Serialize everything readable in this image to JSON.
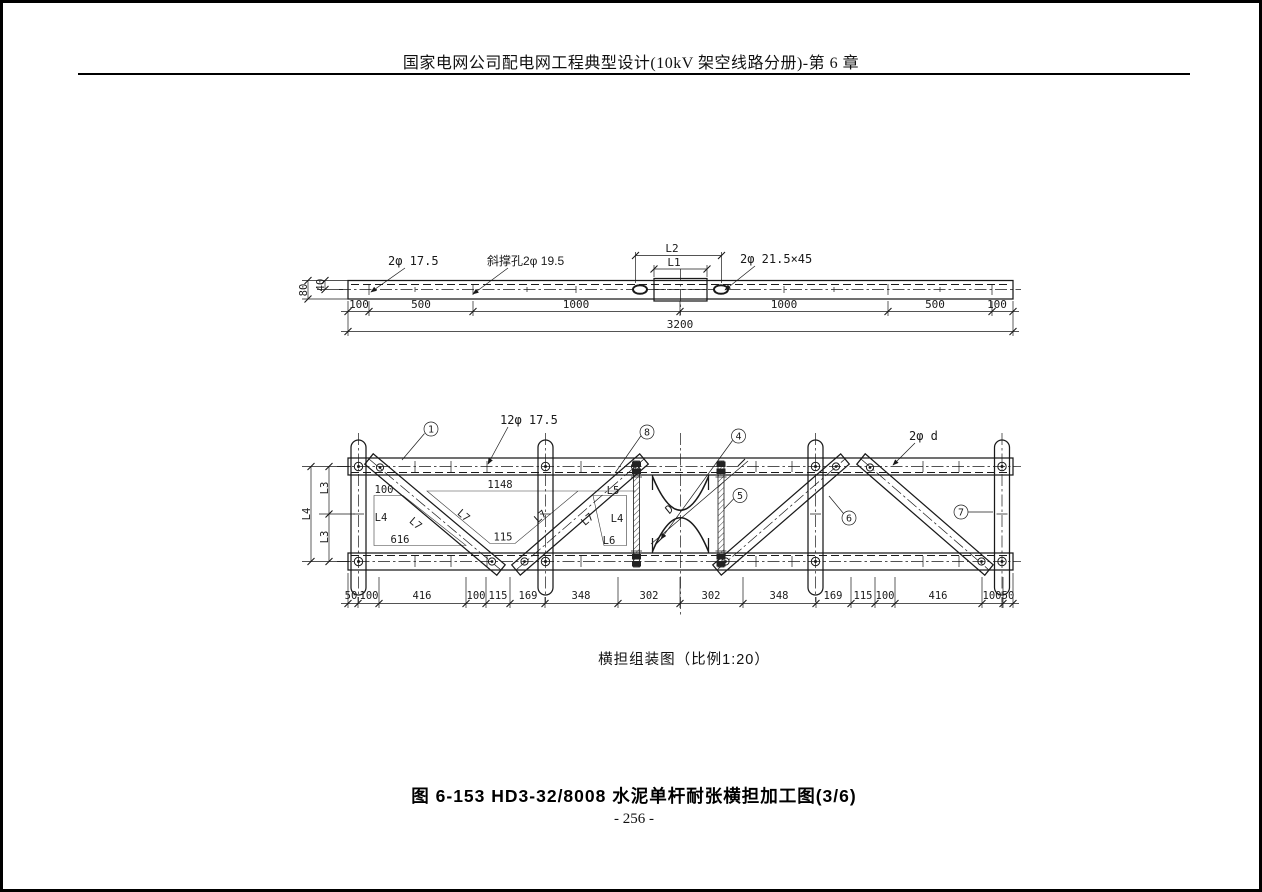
{
  "header": {
    "title": "国家电网公司配电网工程典型设计(10kV 架空线路分册)-第 6 章"
  },
  "bar_detail": {
    "label_holes": "2φ 17.5",
    "label_brace_holes": "斜撑孔2φ 19.5",
    "label_slot": "2φ 21.5×45",
    "dim_l2": "L2",
    "dim_l1": "L1",
    "dim_height": "80",
    "dim_half_height": "40",
    "segment_dims": [
      "100",
      "500",
      "1000",
      "1000",
      "500",
      "100"
    ],
    "dim_total": "3200"
  },
  "assembly": {
    "caption": "横担组装图（比例1:20）",
    "label_holes": "12φ 17.5",
    "label_bolt": "2φ d",
    "dim_d": "D",
    "callouts": {
      "c1": "1",
      "c4": "4",
      "c5": "5",
      "c6": "6",
      "c7": "7",
      "c8": "8"
    },
    "side_dims": {
      "l3": "L3",
      "l4": "L4"
    },
    "panel_labels": {
      "p100": "100",
      "p616": "616",
      "p1148": "1148",
      "p115": "115",
      "l4": "L4",
      "l5": "L5",
      "l6": "L6",
      "l7": "L7"
    },
    "bottom_dims": [
      "50",
      "100",
      "416",
      "100",
      "115",
      "169",
      "348",
      "302",
      "302",
      "348",
      "169",
      "115",
      "100",
      "416",
      "100",
      "50"
    ]
  },
  "figure": {
    "caption": "图 6-153  HD3-32/8008 水泥单杆耐张横担加工图(3/6)",
    "page_number": "- 256 -"
  }
}
